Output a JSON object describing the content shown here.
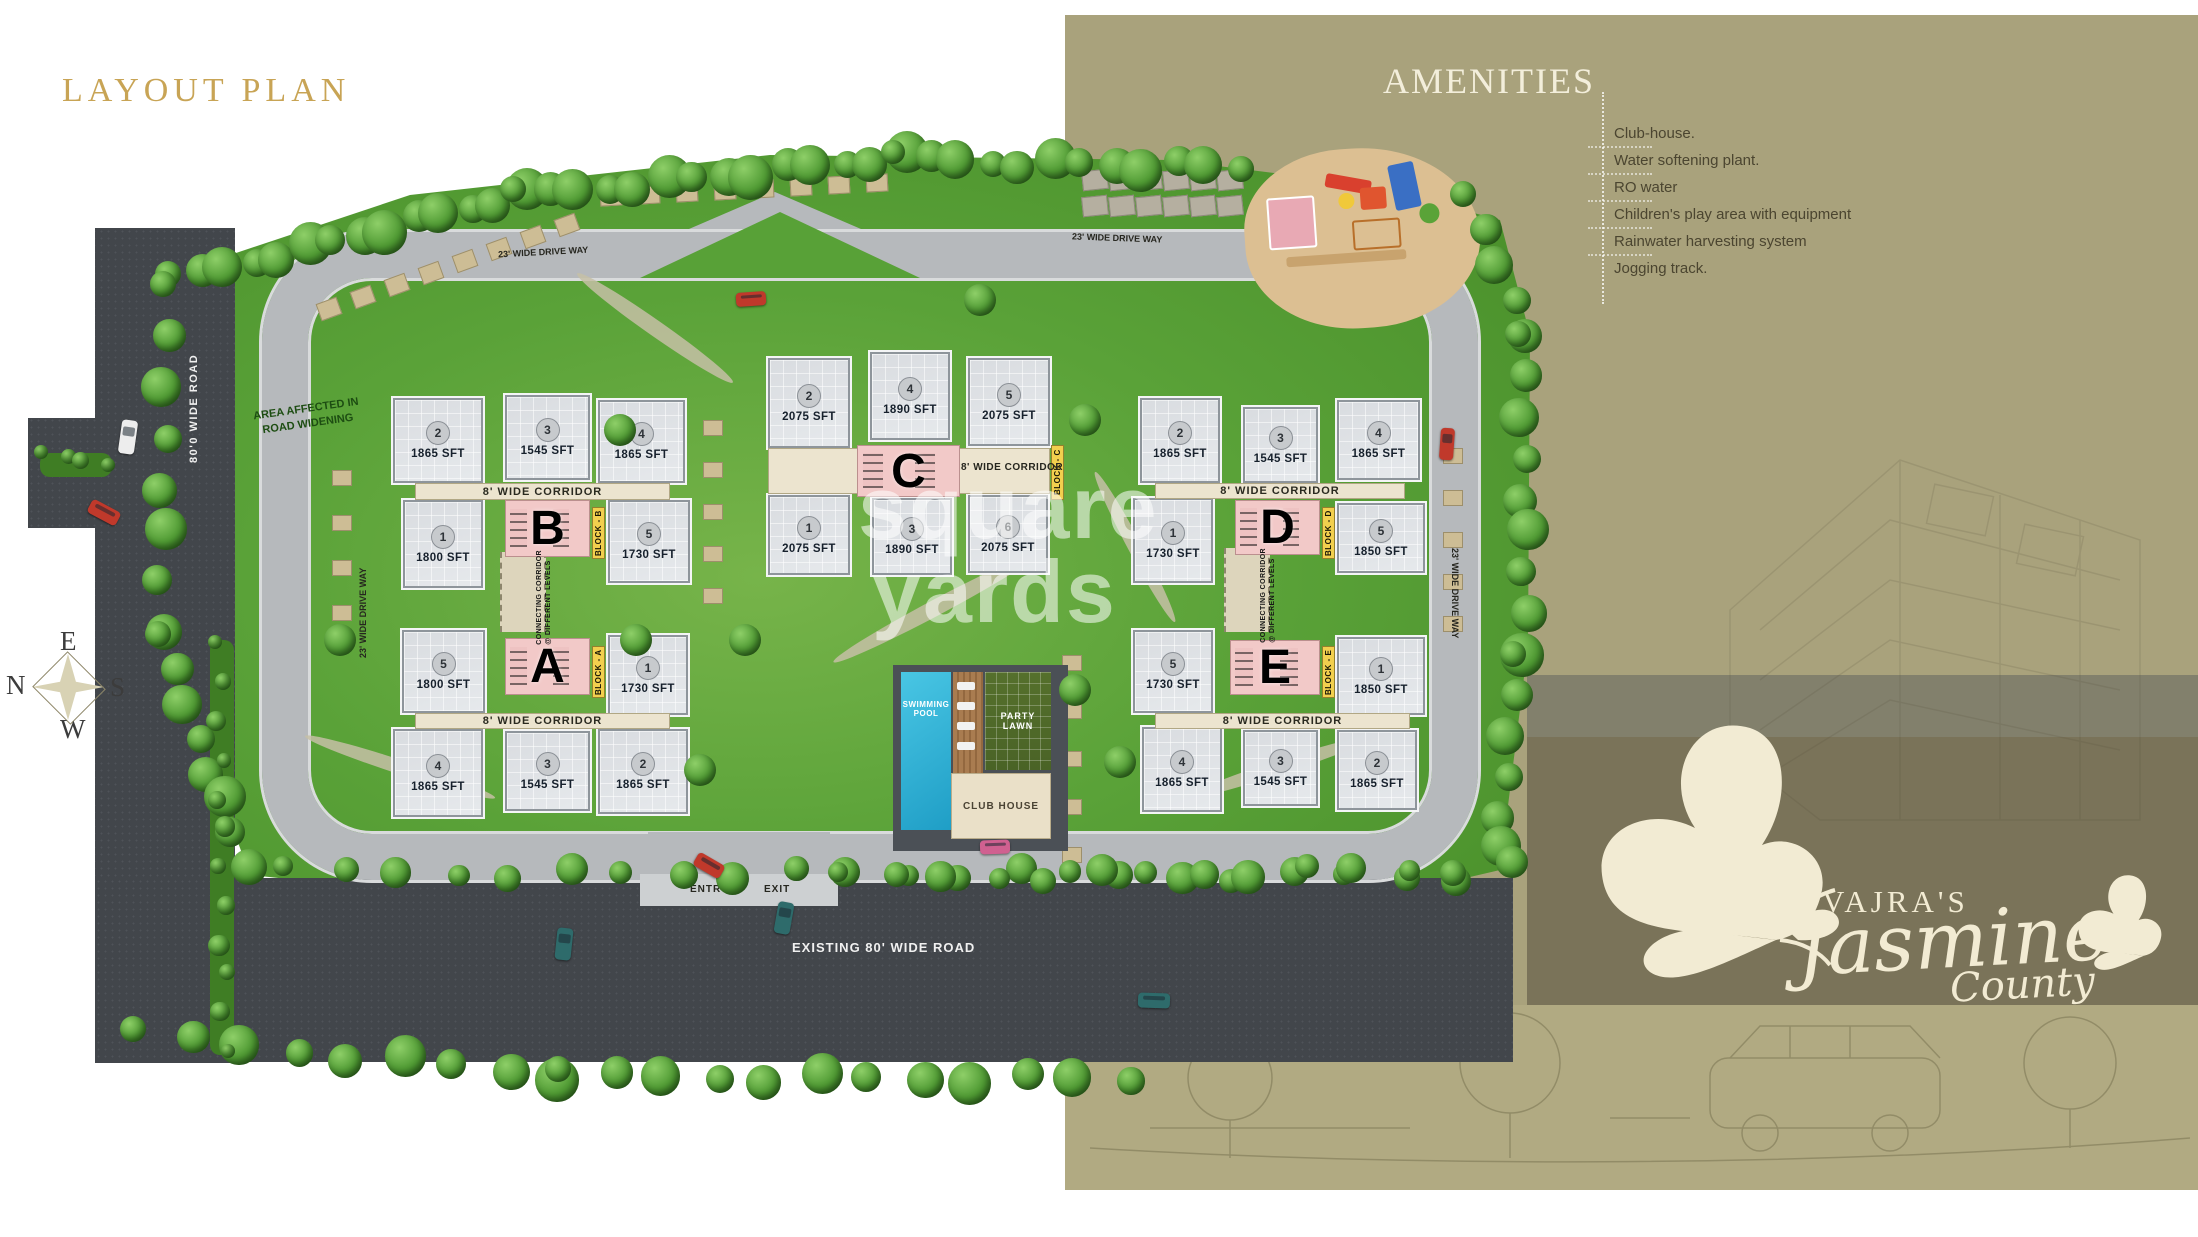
{
  "title": "LAYOUT PLAN",
  "amenities": {
    "heading": "AMENITIES",
    "items": [
      "Club-house.",
      "Water softening plant.",
      "RO water",
      "Children's play area with equipment",
      "Rainwater harvesting system",
      "Jogging track."
    ]
  },
  "brand": {
    "owner": "VAJRA'S",
    "name": "Jasmine",
    "sub": "County"
  },
  "compass": {
    "top": "E",
    "left": "N",
    "right": "S",
    "bottom": "W"
  },
  "watermark": {
    "line1": "square",
    "line2": "yards"
  },
  "site": {
    "corridor": "8' WIDE CORRIDOR",
    "connecting1": "CONNECTING CORRIDOR",
    "connecting2": "@ DIFFERENT LEVELS",
    "driveway": "23' WIDE DRIVE WAY",
    "left_road": "80'0 WIDE ROAD",
    "existing_road": "EXISTING 80' WIDE ROAD",
    "entry": "ENTRY",
    "exit": "EXIT",
    "area_affected1": "AREA AFFECTED IN",
    "area_affected2": "ROAD WIDENING",
    "pool1": "SWIMMING",
    "pool2": "POOL",
    "lawn1": "PARTY",
    "lawn2": "LAWN",
    "club": "CLUB HOUSE"
  },
  "blocks": {
    "A": {
      "letter": "A",
      "tag": "BLOCK - A",
      "row1": [
        {
          "no": "5",
          "area": "1800 SFT"
        },
        {
          "no": "1",
          "area": "1730 SFT"
        }
      ],
      "row2": [
        {
          "no": "4",
          "area": "1865 SFT"
        },
        {
          "no": "3",
          "area": "1545 SFT"
        },
        {
          "no": "2",
          "area": "1865 SFT"
        }
      ]
    },
    "B": {
      "letter": "B",
      "tag": "BLOCK - B",
      "row1": [
        {
          "no": "2",
          "area": "1865 SFT"
        },
        {
          "no": "3",
          "area": "1545 SFT"
        },
        {
          "no": "4",
          "area": "1865 SFT"
        }
      ],
      "row2": [
        {
          "no": "1",
          "area": "1800 SFT"
        },
        {
          "no": "5",
          "area": "1730 SFT"
        }
      ]
    },
    "C": {
      "letter": "C",
      "tag": "BLOCK - C",
      "row1": [
        {
          "no": "2",
          "area": "2075 SFT"
        },
        {
          "no": "4",
          "area": "1890 SFT"
        },
        {
          "no": "5",
          "area": "2075 SFT"
        }
      ],
      "row2": [
        {
          "no": "1",
          "area": "2075 SFT"
        },
        {
          "no": "3",
          "area": "1890 SFT"
        },
        {
          "no": "6",
          "area": "2075 SFT"
        }
      ]
    },
    "D": {
      "letter": "D",
      "tag": "BLOCK - D",
      "row1": [
        {
          "no": "2",
          "area": "1865 SFT"
        },
        {
          "no": "3",
          "area": "1545 SFT"
        },
        {
          "no": "4",
          "area": "1865 SFT"
        }
      ],
      "row2": [
        {
          "no": "1",
          "area": "1730 SFT"
        },
        {
          "no": "5",
          "area": "1850 SFT"
        }
      ]
    },
    "E": {
      "letter": "E",
      "tag": "BLOCK - E",
      "row1": [
        {
          "no": "5",
          "area": "1730 SFT"
        },
        {
          "no": "1",
          "area": "1850 SFT"
        }
      ],
      "row2": [
        {
          "no": "4",
          "area": "1865 SFT"
        },
        {
          "no": "3",
          "area": "1545 SFT"
        },
        {
          "no": "2",
          "area": "1865 SFT"
        }
      ]
    }
  }
}
